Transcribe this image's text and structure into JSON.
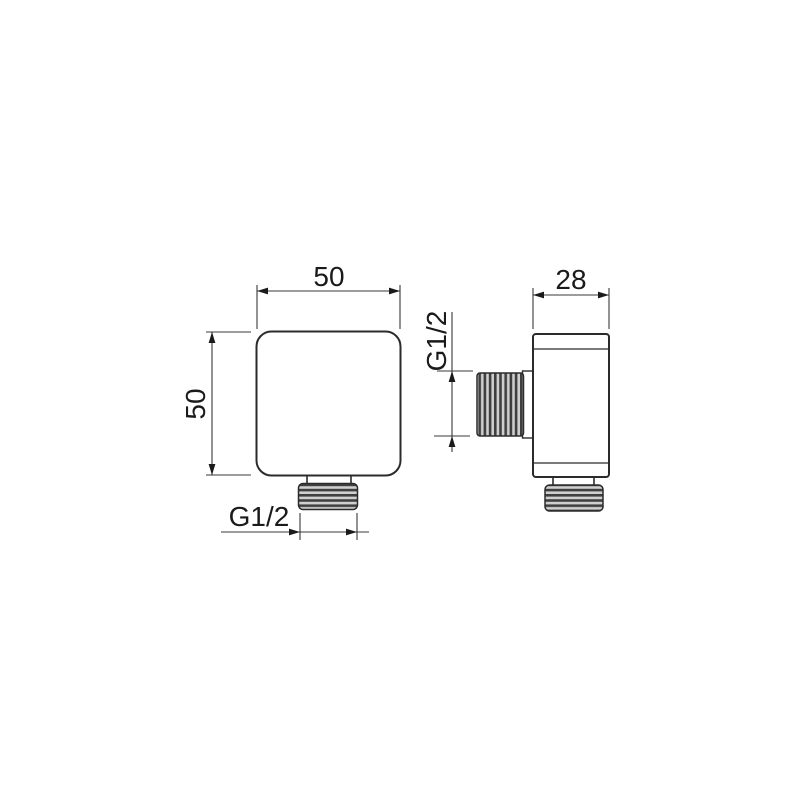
{
  "drawing": {
    "type": "technical-dimension-drawing",
    "part": "square wall outlet elbow, front and side orthographic views",
    "front_view": {
      "width_label": "50",
      "height_label": "50",
      "outlet_thread_label": "G1/2"
    },
    "side_view": {
      "depth_label": "28",
      "inlet_thread_label": "G1/2"
    },
    "colors": {
      "background": "#ffffff",
      "line": "#2b2b2b",
      "dimension_line": "#3a3a3a",
      "text": "#1a1a1a",
      "thread_dark": "#3f3f3f",
      "thread_light": "#cfcfcf"
    }
  }
}
